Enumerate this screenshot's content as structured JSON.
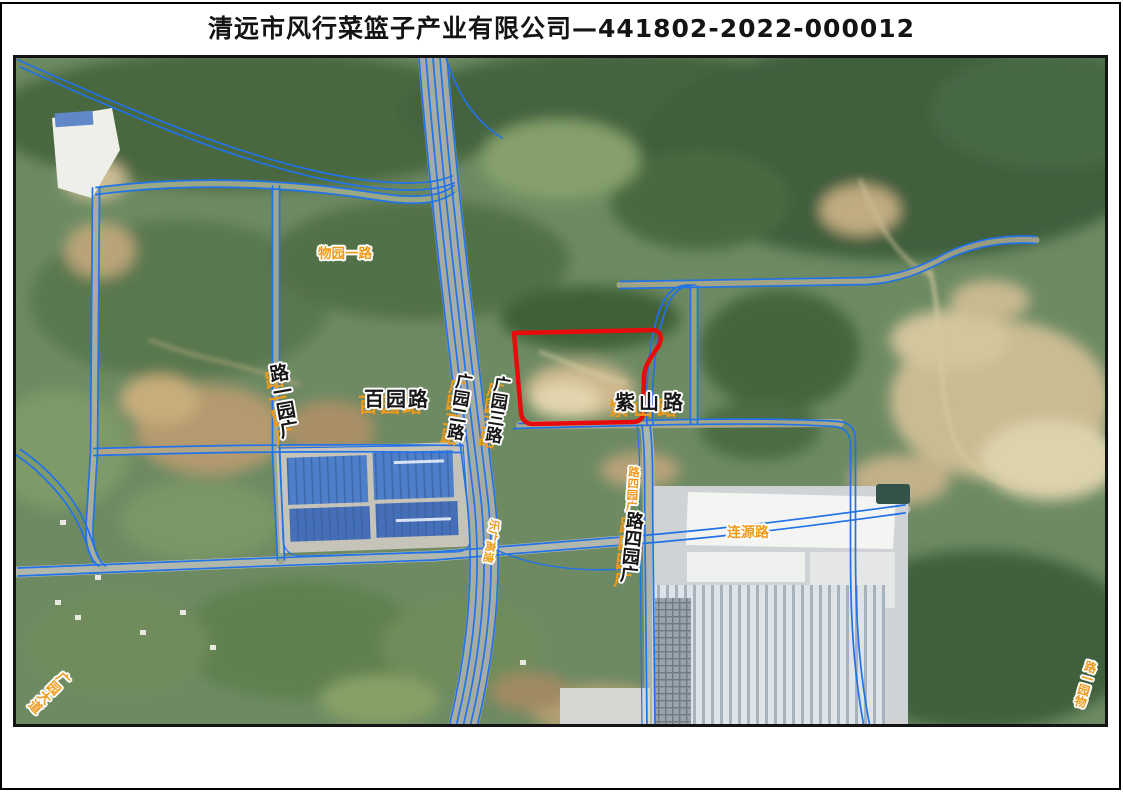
{
  "title": "清远市风行菜篮子产业有限公司—441802-2022-000012",
  "map": {
    "type": "satellite-imagery-with-road-annotations",
    "parcel_id": "441802-2022-000012",
    "colors": {
      "road_annotation_blue": "#2272e8",
      "parcel_boundary_red": "#e80b0b",
      "label_orange": "#f09a1a",
      "label_black": "#161616"
    },
    "labels": [
      {
        "id": "wuyuan-yilu-top",
        "road": "物园一路",
        "display": "物园一路",
        "color": "orange",
        "orientation": "horizontal"
      },
      {
        "id": "guangyuan-yilu",
        "road": "广园一路",
        "display": "路一园广",
        "color": "black",
        "orientation": "vertical"
      },
      {
        "id": "baiyuan-lu",
        "road": "百园路",
        "display": "百园路",
        "color": "black",
        "orientation": "horizontal"
      },
      {
        "id": "guangyuan-erlu",
        "road": "广园二路",
        "display": "广园二路",
        "color": "black",
        "orientation": "vertical"
      },
      {
        "id": "guangyuan-sanlu",
        "road": "广园三路",
        "display": "广园三路",
        "color": "black",
        "orientation": "vertical"
      },
      {
        "id": "zishan-lu",
        "road": "紫山路",
        "display": "紫山路",
        "color": "black",
        "orientation": "horizontal"
      },
      {
        "id": "guangyuan-silu-orange",
        "road": "广园四路",
        "display": "路四园广",
        "color": "orange",
        "orientation": "vertical"
      },
      {
        "id": "guangyuan-silu-black",
        "road": "广园四路",
        "display": "路四园广",
        "color": "black",
        "orientation": "vertical"
      },
      {
        "id": "leguang-gaosu",
        "road": "乐广高速",
        "display": "乐广高速",
        "color": "orange",
        "orientation": "vertical-sideways"
      },
      {
        "id": "lianyuan-lu",
        "road": "连源路",
        "display": "连源路",
        "color": "orange",
        "orientation": "horizontal"
      },
      {
        "id": "guangyuan-dadao",
        "road": "广园大道",
        "display": "广园大道",
        "color": "orange",
        "orientation": "diagonal"
      },
      {
        "id": "wuyuan-yilu-bottom",
        "road": "物园一路",
        "display": "路一园物",
        "color": "orange",
        "orientation": "vertical"
      }
    ]
  }
}
